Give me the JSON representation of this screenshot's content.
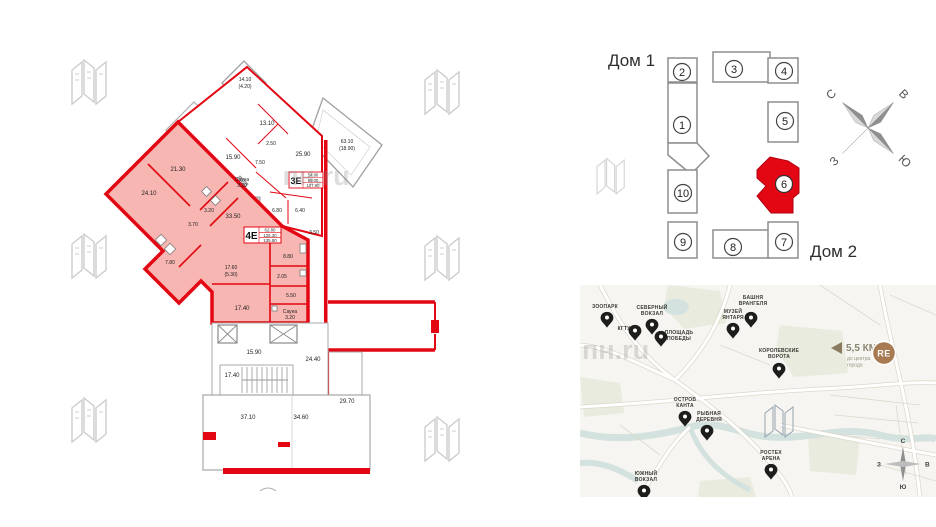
{
  "plan": {
    "unit": {
      "code": "4Е",
      "area_living": "62.80",
      "area_total": "126.30",
      "area_with_summer": "135.80"
    },
    "neighbor": {
      "code": "3Е",
      "area_living": "54.90",
      "area_total": "89.00",
      "area_with_summer": "107.90"
    },
    "labels": {
      "r2130": "21.30",
      "r2410": "24.10",
      "r320": "3.20",
      "r370": "3.70",
      "r780": "7.80",
      "r3350": "33.50",
      "r880": "8.80",
      "r1760": "17.60",
      "r1760s": "(5.30)",
      "r205": "2.05",
      "r550": "5.50",
      "r1740": "17.40",
      "rsauna": "Сауна",
      "rsauna_v": "3.20",
      "n1410": "14.10",
      "n1410s": "(4.20)",
      "n1310": "13.10",
      "n250": "2.50",
      "n1590": "15.90",
      "n2590": "25.90",
      "n750": "7.50",
      "nsauna": "Сауна",
      "nsauna_v": "3.20",
      "n680": "6.80",
      "n640": "6.40",
      "n6310": "63.10",
      "n6310s": "(18.90)",
      "n350": "3.50",
      "c1590": "15.90",
      "c2440": "24.40",
      "c1740": "17.40",
      "c2970": "29.70",
      "c3710": "37.10",
      "c3460": "34.60"
    },
    "watermark": "пн.ru"
  },
  "scheme": {
    "house1": "Дом 1",
    "house2": "Дом 2",
    "units": [
      "1",
      "2",
      "3",
      "4",
      "5",
      "6",
      "7",
      "8",
      "9",
      "10"
    ],
    "highlighted_unit": "6",
    "compass": {
      "n": "С",
      "e": "В",
      "s": "Ю",
      "w": "З"
    }
  },
  "map": {
    "watermark": "пн.ru",
    "distance": {
      "value": "5,5 КМ",
      "line1": "до центра",
      "line2": "города"
    },
    "logo": "RE",
    "compass": {
      "n": "С",
      "e": "В",
      "s": "Ю",
      "w": "З"
    },
    "landmarks": [
      {
        "l1": "ЗООПАРК",
        "l2": ""
      },
      {
        "l1": "КГТУ",
        "l2": ""
      },
      {
        "l1": "СЕВЕРНЫЙ",
        "l2": "ВОКЗАЛ"
      },
      {
        "l1": "ПЛОЩАДЬ",
        "l2": "ПОБЕДЫ"
      },
      {
        "l1": "МУЗЕЙ",
        "l2": "ЯНТАРЯ"
      },
      {
        "l1": "БАШНЯ",
        "l2": "ВРАНГЕЛЯ"
      },
      {
        "l1": "КОРОЛЕВСКИЕ",
        "l2": "ВОРОТА"
      },
      {
        "l1": "ОСТРОВ",
        "l2": "КАНТА"
      },
      {
        "l1": "РЫБНАЯ",
        "l2": "ДЕРЕВНЯ"
      },
      {
        "l1": "РОСТЕХ",
        "l2": "АРЕНА"
      },
      {
        "l1": "ЮЖНЫЙ",
        "l2": "ВОКЗАЛ"
      }
    ]
  },
  "colors": {
    "accent_red": "#e30613",
    "plan_fill": "#f7b6b1",
    "wall_gray": "#a9a9a9",
    "logo_brown": "#a87a52",
    "pin_black": "#1d1d1b",
    "map_bg": "#f6f5f1"
  }
}
